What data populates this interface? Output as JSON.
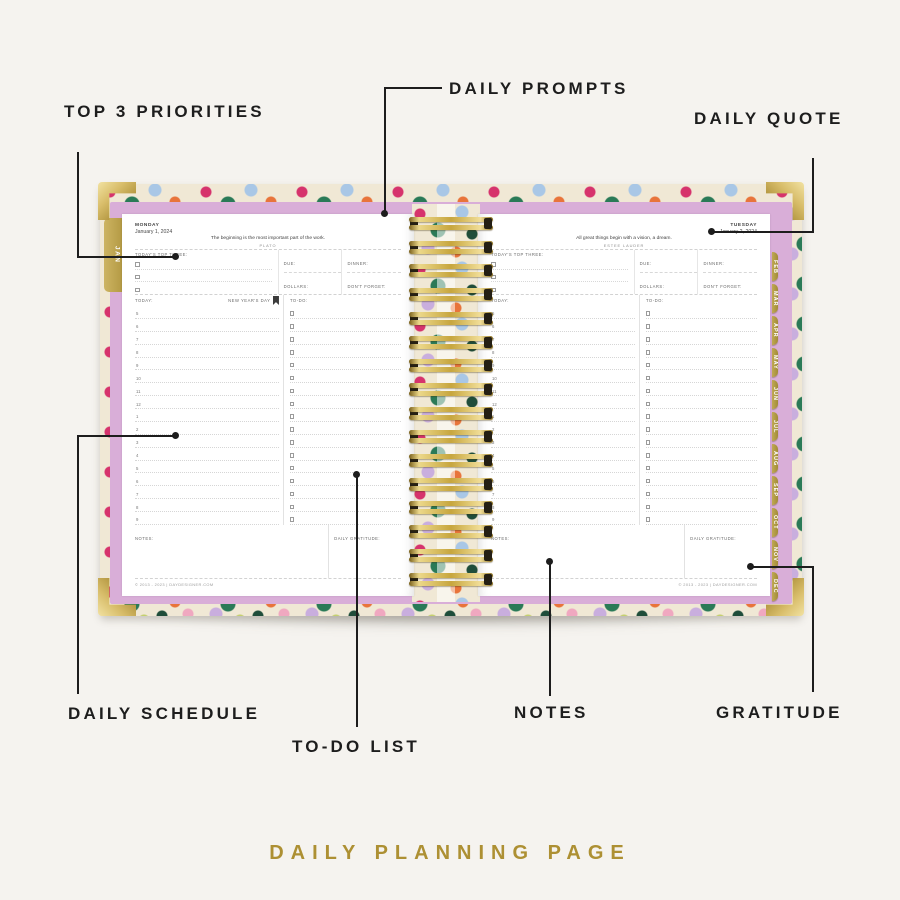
{
  "caption": "DAILY PLANNING PAGE",
  "callouts": {
    "top_priorities": "TOP 3 PRIORITIES",
    "daily_prompts": "DAILY PROMPTS",
    "daily_quote": "DAILY QUOTE",
    "daily_schedule": "DAILY SCHEDULE",
    "todo_list": "TO-DO LIST",
    "notes": "NOTES",
    "gratitude": "GRATITUDE"
  },
  "planner": {
    "month_tab_left": "JAN",
    "month_tabs_right": [
      "FEB",
      "MAR",
      "APR",
      "MAY",
      "JUN",
      "JUL",
      "AUG",
      "SEP",
      "OCT",
      "NOV",
      "DEC"
    ],
    "section_labels": {
      "top_three": "TODAY'S TOP THREE:",
      "due": "DUE:",
      "dinner": "DINNER:",
      "dollars": "DOLLARS:",
      "dont_forget": "DON'T FORGET:",
      "today": "TODAY:",
      "todo": "TO-DO:",
      "notes": "NOTES:",
      "gratitude": "DAILY GRATITUDE:"
    },
    "schedule_times": [
      "5",
      "6",
      "7",
      "8",
      "9",
      "10",
      "11",
      "12",
      "1",
      "2",
      "3",
      "4",
      "5",
      "6",
      "7",
      "8",
      "9"
    ],
    "top_three_slots": 3,
    "coil_count": 16,
    "left_page": {
      "day": "MONDAY",
      "date": "January 1, 2024",
      "quote": "The beginning is the most important part of the work.",
      "quote_author": "PLATO",
      "holiday": "NEW YEAR'S DAY",
      "footer": "© 2013 - 2023  |  DAYDESIGNER.COM"
    },
    "right_page": {
      "day": "TUESDAY",
      "date": "January 2, 2024",
      "quote": "All great things begin with a vision, a dream.",
      "quote_author": "ESTEE LAUDER",
      "footer": "© 2013 - 2023  |  DAYDESIGNER.COM"
    }
  },
  "colors": {
    "background": "#f5f3ef",
    "caption_gold": "#ad9033",
    "callout_ink": "#1d1d1d",
    "tab_gold": "#b39c4a",
    "coil_gold": "#c9ad52",
    "cover_lavender": "#d9aed8",
    "page_white": "#ffffff"
  }
}
